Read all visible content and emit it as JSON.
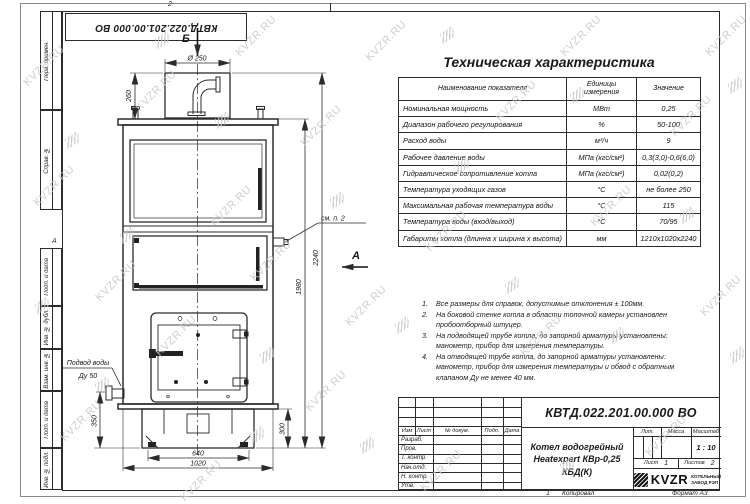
{
  "watermark": {
    "text": "KVZR.RU"
  },
  "frame": {
    "top_designation": "КВТД.022.201.00.000 ВО",
    "left_top_labels": [
      "Перв. примен.",
      "Справ. №"
    ],
    "left_bottom_labels": [
      "Подп. и дата",
      "Инв. № дубл.",
      "Взам. инв. №",
      "Подп. и дата",
      "Инв. № подл."
    ],
    "zone_top": "2",
    "zone_bottom": "1",
    "zone_left": "А",
    "copy_label": "Копировал",
    "format_label": "Формат А3"
  },
  "drawing": {
    "labels": {
      "view_b": "Б",
      "view_a": "А",
      "diameter": "Ø 250",
      "dim_260": "260",
      "dim_1980": "1980",
      "dim_2240": "2240",
      "dim_350": "350",
      "dim_300": "300",
      "dim_640": "640",
      "dim_1020": "1020",
      "note_ref": "см. п. 2",
      "water_inlet_line1": "Подвод воды",
      "water_inlet_line2": "Ду 50"
    }
  },
  "spec_table": {
    "title": "Техническая характеристика",
    "headers": [
      "Наименование показателя",
      "Единицы измерения",
      "Значение"
    ],
    "rows": [
      [
        "Номинальная мощность",
        "МВт",
        "0,25"
      ],
      [
        "Диапазон рабочего регулирования",
        "%",
        "50-100"
      ],
      [
        "Расход воды",
        "м³/ч",
        "9"
      ],
      [
        "Рабочее давление воды",
        "МПа (кгс/см²)",
        "0,3(3,0)-0,6(6,0)"
      ],
      [
        "Гидравлическое сопротивление котла",
        "МПа (кгс/см²)",
        "0,02(0,2)"
      ],
      [
        "Температура уходящих газов",
        "°С",
        "не более 250"
      ],
      [
        "Максимальная рабочая температура воды",
        "°С",
        "115"
      ],
      [
        "Температура воды (вход/выход)",
        "°С",
        "70/95"
      ],
      [
        "Габариты котла (длинна х ширина х высота)",
        "мм",
        "1210х1020х2240"
      ]
    ]
  },
  "notes": {
    "items": [
      "Все размеры для справок, допустимые отклонения ± 100мм.",
      "На боковой стенке котла в области топочной камеры установлен пробоотборный штуцер.",
      "На подводящей трубе котла, до запорной арматуры установлены: манометр, прибор для измерения температуры.",
      "На отводящей трубе котла, до запорной арматуры установлены: манометр, прибор для измерения температуры и обвод с обратным клапаном Ду не менее 40 мм."
    ]
  },
  "title_block": {
    "designation": "КВТД.022.201.00.000 ВО",
    "name_line1": "Котел водогрейный",
    "name_line2": "Heatexpert КВр-0,25 КБД(К)",
    "header_cols": [
      "Изм",
      "Лист",
      "№ докум.",
      "Подп.",
      "Дата"
    ],
    "sig_rows": [
      "Разраб.",
      "Пров.",
      "Т. контр.",
      "Нач.отд.",
      "Н. контр.",
      "Утв."
    ],
    "lit_label": "Лит.",
    "mass_label": "Масса",
    "scale_label": "Масштаб",
    "scale_value": "1 : 10",
    "sheet_label": "Лист",
    "sheet_value": "1",
    "sheets_label": "Листов",
    "sheets_value": "2",
    "logo_text": "KVZR",
    "logo_sub1": "КОТЕЛЬНЫЙ",
    "logo_sub2": "ЗАВОД РЭП"
  }
}
